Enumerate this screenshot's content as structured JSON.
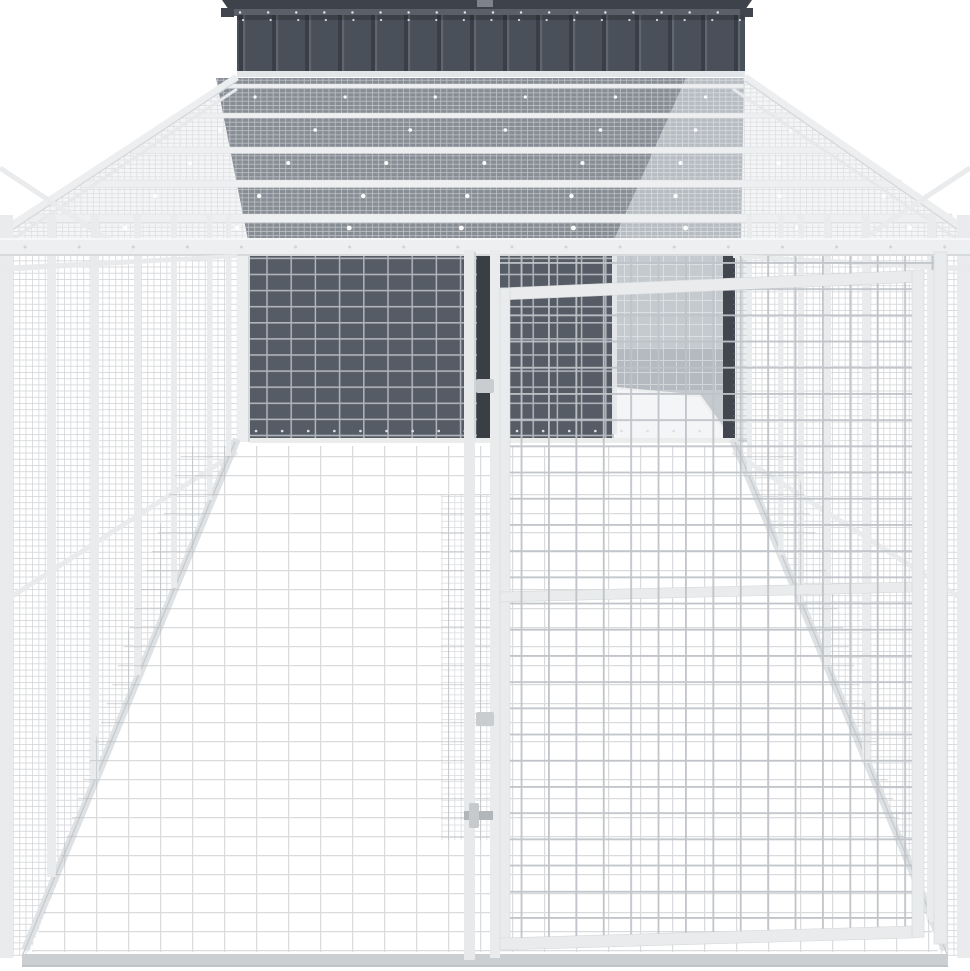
{
  "meta": {
    "title": "Dog house with large wire mesh run",
    "description": "Product photo on a white background: an anthracite grey steel dog house with an apex roof and corrugated gable, attached to a long light-grey galvanised steel walk-in run made of fine wire mesh panels, a full mesh roof with cross rafters, an internal mesh gate with a slide latch, and an open doorway revealing the light grey house interior.",
    "width_px": 970,
    "height_px": 971
  },
  "palette": {
    "background": "#ffffff",
    "roof": "#3e434b",
    "roof_trim": "#5a6068",
    "roof_tab": "#41464e",
    "ridge_cap": "#7d838b",
    "house_wall": "#4a505a",
    "house_wall_groove": "#3a3f47",
    "wall_through_roof_mesh": "#878d95",
    "interior_through_roof_mesh": "#b7bcc2",
    "house_front_wall": "#565c65",
    "house_interior": "#c5cacf",
    "house_interior_shadow": "#b4bac0",
    "doorway_edge": "#42474f",
    "doorway_slot": "#3a3f46",
    "frame": "#edeff0",
    "frame_edge": "#d6d9db",
    "mesh_line": "#bfc3c8",
    "grid_on_wall": "#b0b5bc",
    "base_rail": "#cbcfd2",
    "floor_rail": "#dfe2e4",
    "latch": "#b1b6ba",
    "latch_handle": "#c6cacd",
    "floor": "#ffffff"
  },
  "parts": {
    "house": "anthracite steel dog house",
    "roof": "apex roof with ridge cap and screw row",
    "gable": "corrugated front gable panel",
    "run": "galvanised steel mesh run",
    "roof_mesh": "wire mesh run roof with five cross rafters",
    "left_wall": "left mesh side wall with posts",
    "right_wall": "right mesh side wall with posts",
    "gate": "internal mesh gate with frame",
    "latch": "slide latch on gate post",
    "doorway": "open doorway to house interior",
    "floor": "white ground with faint mesh shadow grid"
  }
}
